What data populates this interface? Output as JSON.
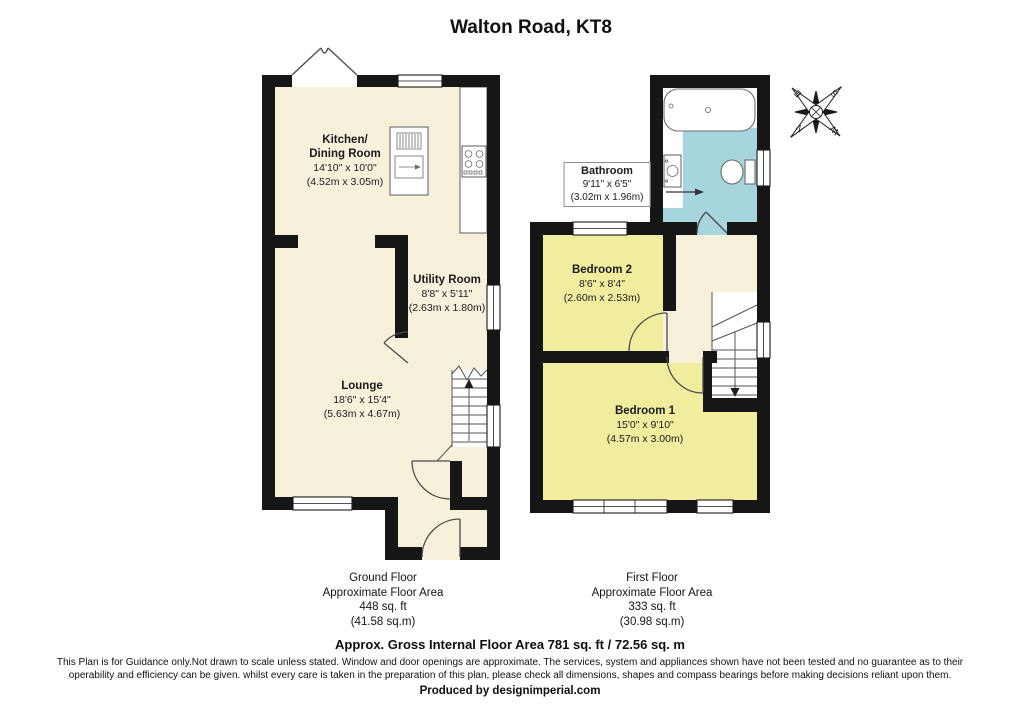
{
  "title": "Walton Road, KT8",
  "rooms": {
    "kitchen": {
      "name1": "Kitchen/",
      "name2": "Dining Room",
      "dims_ft": "14'10\" x 10'0\"",
      "dims_m": "(4.52m x 3.05m)"
    },
    "utility": {
      "name1": "Utility Room",
      "dims_ft": "8'8\" x 5'11\"",
      "dims_m": "(2.63m x 1.80m)"
    },
    "lounge": {
      "name1": "Lounge",
      "dims_ft": "18'6\" x 15'4\"",
      "dims_m": "(5.63m x 4.67m)"
    },
    "bathroom": {
      "name1": "Bathroom",
      "dims_ft": "9'11\" x 6'5\"",
      "dims_m": "(3.02m x 1.96m)"
    },
    "bedroom2": {
      "name1": "Bedroom 2",
      "dims_ft": "8'6\" x 8'4\"",
      "dims_m": "(2.60m x 2.53m)"
    },
    "bedroom1": {
      "name1": "Bedroom 1",
      "dims_ft": "15'0\" x 9'10\"",
      "dims_m": "(4.57m x 3.00m)"
    }
  },
  "floors": {
    "ground": {
      "name": "Ground Floor",
      "area_label": "Approximate Floor Area",
      "area_ft": "448 sq. ft",
      "area_m": "(41.58 sq.m)"
    },
    "first": {
      "name": "First Floor",
      "area_label": "Approximate Floor Area",
      "area_ft": "333 sq. ft",
      "area_m": "(30.98 sq.m)"
    }
  },
  "compass": {
    "n": "N",
    "e": "E",
    "s": "S",
    "w": "W"
  },
  "footer": {
    "total_area": "Approx. Gross Internal Floor Area 781 sq. ft / 72.56 sq. m",
    "disclaimer_line1": "This Plan is for Guidance only.Not drawn to scale unless stated. Window and door openings are approximate. The services, system and appliances shown have not been tested and no guarantee as to their",
    "disclaimer_line2": "operability and efficiency can be given. whilst every care is taken in the preparation of this plan, please check all dimensions, shapes and compass bearings before making decisions reliant upon them.",
    "produced_by": "Produced by designimperial.com"
  },
  "colors": {
    "wall": "#161616",
    "room_cream": "#f7f1dc",
    "room_yellow": "#f0ed9f",
    "room_blue": "#a7d5dd"
  }
}
